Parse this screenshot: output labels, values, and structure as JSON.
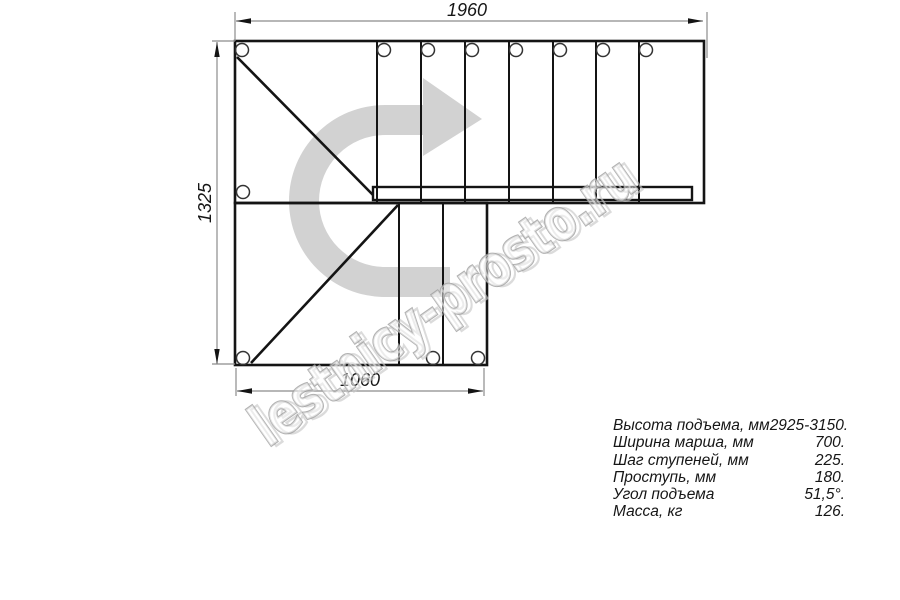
{
  "drawing": {
    "title": "l-shaped-staircase-plan",
    "dimensions": {
      "top_width": "1960",
      "left_height": "1325",
      "bottom_width": "1060"
    }
  },
  "specs": {
    "rows": [
      {
        "label": "Высота подъема, мм",
        "value": "2925-3150."
      },
      {
        "label": "Ширина марша, мм",
        "value": "700."
      },
      {
        "label": "Шаг ступеней, мм",
        "value": "225."
      },
      {
        "label": "Проступь, мм",
        "value": "180."
      },
      {
        "label": "Угол подъема",
        "value": "51,5°."
      },
      {
        "label": "Масса, кг",
        "value": "126."
      }
    ]
  },
  "watermark": {
    "text": "lestnicy-prosto.ru",
    "arrow_icon": "u-turn-right-arrow",
    "arrow_color": "#d2d2d2",
    "text_outline_color": "#9f9f9f"
  },
  "colors": {
    "background": "#ffffff",
    "line": "#141414",
    "dimension_line": "#8c8c8c",
    "dimension_text": "#161616"
  }
}
